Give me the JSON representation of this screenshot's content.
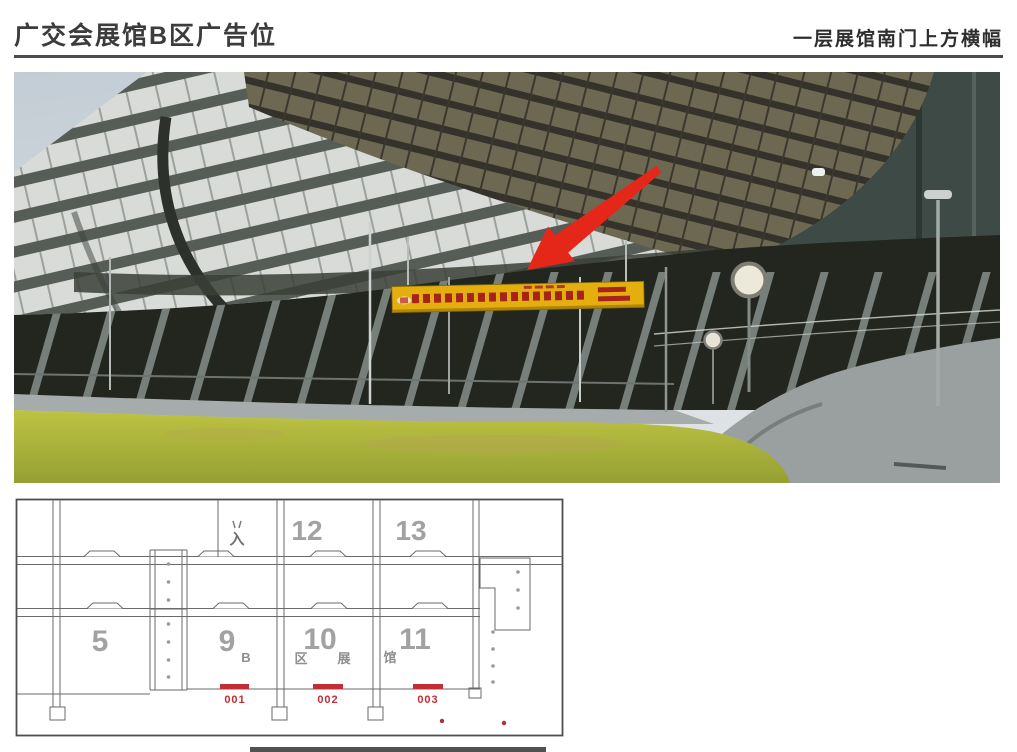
{
  "header": {
    "title_left": "广交会展馆B区广告位",
    "title_right": "一层展馆南门上方横幅"
  },
  "photo": {
    "arrow_color": "#e42718",
    "banner_color": "#e3ae0e"
  },
  "floor_plan": {
    "halls": [
      {
        "id": "5"
      },
      {
        "id": "9"
      },
      {
        "id": "10"
      },
      {
        "id": "11"
      },
      {
        "id": "12"
      },
      {
        "id": "13"
      }
    ],
    "zone_chars": [
      {
        "ch": "B"
      },
      {
        "ch": "区"
      },
      {
        "ch": "展"
      },
      {
        "ch": "馆"
      }
    ],
    "entrance_char": "入",
    "positions": [
      {
        "id": "001"
      },
      {
        "id": "002"
      },
      {
        "id": "003"
      }
    ],
    "highlight_color": "#c22d36"
  }
}
